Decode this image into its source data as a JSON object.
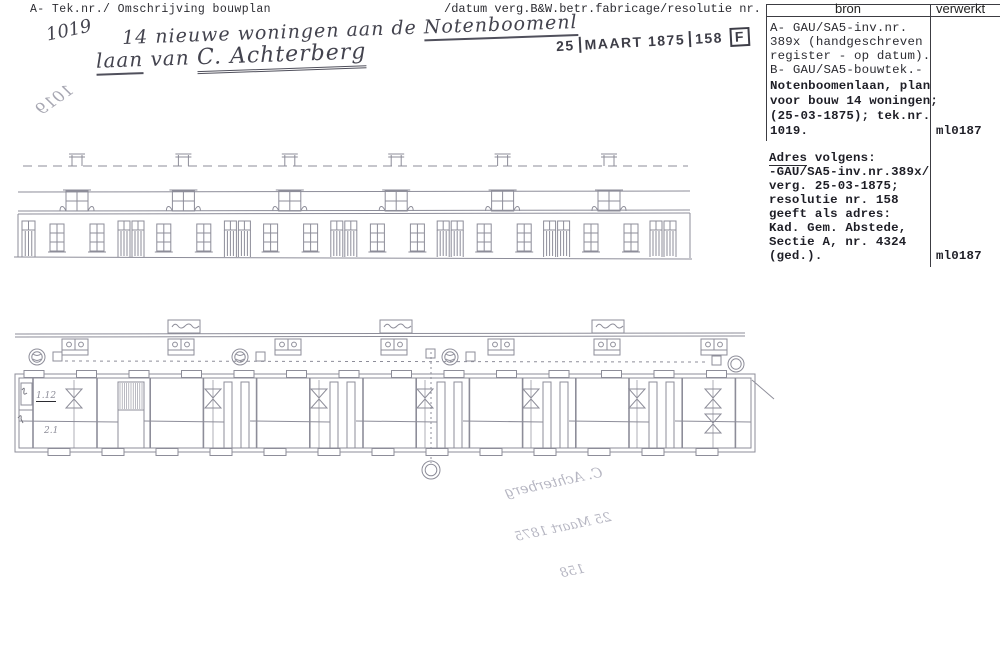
{
  "header": {
    "left": "A- Tek.nr./ Omschrijving bouwplan",
    "right": "/datum verg.B&W.betr.fabricage/resolutie nr."
  },
  "handwritten": {
    "tek_nr": "1019",
    "line1_pre": "14 nieuwe woningen aan de ",
    "line1_u": "Notenboomenl",
    "line2_u": "laan",
    "line2_mid": " van ",
    "line2_name": "C. Achterberg",
    "mirrored_number": "1019",
    "plan_note_1": "1.12",
    "plan_note_2": "2.1"
  },
  "stamp": {
    "pre": "25",
    "main": "MAART 1875",
    "resolutie": "158",
    "boxed": "F"
  },
  "signature_bleedthrough": {
    "line1": "C. Achterberg",
    "line2": "25 Maart 1875",
    "line3": "158"
  },
  "table": {
    "col1_header": "bron",
    "col2_header": "verwerkt",
    "block1": {
      "lines": [
        "A- GAU/SA5-inv.nr.",
        "389x (handgeschreven",
        "register - op datum).",
        "B- GAU/SA5-bouwtek.-"
      ],
      "lines2": [
        "Notenboomenlaan, plan",
        "voor bouw 14 woningen;",
        "(25-03-1875); tek.nr.",
        "1019."
      ],
      "verwerkt": "ml0187"
    },
    "block2": {
      "line1_u": "Adres",
      "line1_rest": " volgens:",
      "lines": [
        "-GAU/SA5-inv.nr.389x/",
        "verg. 25-03-1875;",
        "resolutie nr. 158",
        "geeft als adres:",
        "Kad. Gem. Abstede,",
        "Sectie A, nr. 4324",
        "(ged.)."
      ],
      "verwerkt": "ml0187"
    }
  },
  "drawing": {
    "stroke": "#8d8d99",
    "elevation_bays": 6,
    "plan_privies": 7,
    "house_count": 14
  }
}
